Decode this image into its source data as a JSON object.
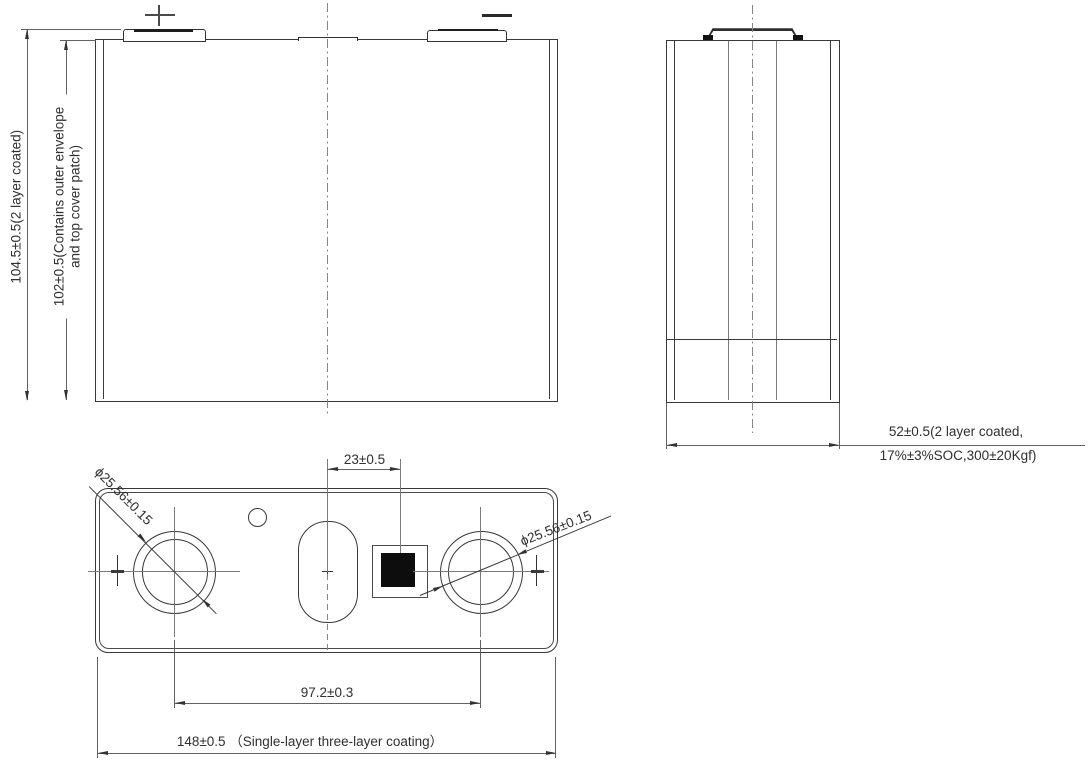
{
  "drawing_type": "battery cell engineering drawing, three orthographic views",
  "symbols": {
    "positive_terminal_mark": "+",
    "negative_terminal_mark": "−"
  },
  "front_view": {
    "dim_total_height": "104.5±0.5(2 layer coated)",
    "dim_case_height_line1": "102±0.5(Contains outer envelope",
    "dim_case_height_line2": "and top cover patch)"
  },
  "side_view": {
    "dim_thickness_line1": "52±0.5(2 layer coated,",
    "dim_thickness_line2": "17%±3%SOC,300±20Kgf)"
  },
  "top_view": {
    "dim_vent_to_code": "23±0.5",
    "dim_left_terminal_dia": "ϕ25.56±0.15",
    "dim_right_terminal_dia": "ϕ25.56±0.15",
    "dim_terminal_pitch": "97.2±0.3",
    "dim_overall_length": "148±0.5 （Single-layer three-layer coating）"
  }
}
